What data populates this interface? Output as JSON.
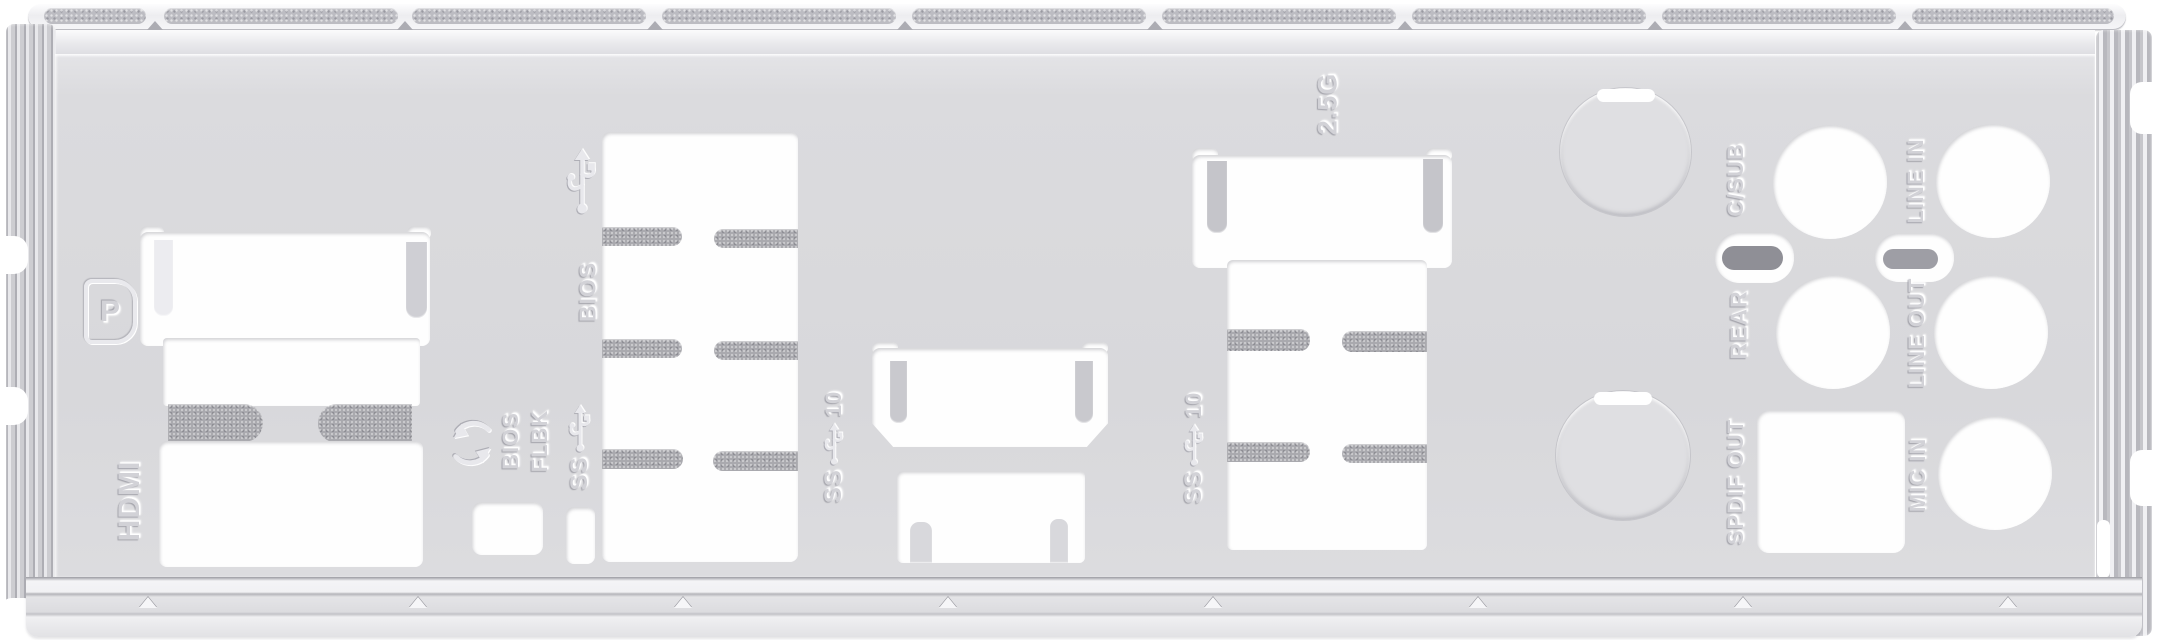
{
  "object": "motherboard-rear-io-shield-photo",
  "description": "Stamped metal I/O shield plate, light gray, with port cutouts, spring fingers, knockout circles and embossed port labels",
  "colors": {
    "plate": "#dbdbde",
    "cutout": "#fefefe",
    "spring_finger": "#a9a9ae",
    "emi_strip": "#bcbcc2",
    "emboss": "#d2d2d7",
    "background": "#ffffff"
  },
  "labels": {
    "display_port_logo": "P",
    "hdmi": "HDMI",
    "usb_bios": "BIOS",
    "bios_flashback_line1": "BIOS",
    "bios_flashback_line2": "FLBK",
    "usb_superspeed": "SS",
    "usb_superspeed10_prefix": "SS",
    "usb_superspeed10_speed": "10",
    "lan_speed": "2.5G",
    "audio_csub": "C/SUB",
    "audio_rear": "REAR",
    "audio_spdif_out": "SPDIF OUT",
    "audio_line_in": "LINE IN",
    "audio_line_out": "LINE OUT",
    "audio_mic_in": "MIC IN"
  },
  "icons": [
    "displayport-logo-icon",
    "usb-trident-icon",
    "usb-ss-trident-icon",
    "usb-ss10-trident-icon",
    "bios-flashback-arrows-icon"
  ],
  "cutouts": [
    "displayport-cutout",
    "hdmi-cutout",
    "usb-stack-4-ports",
    "bios-flashback-button-hole",
    "small-slot-cutout",
    "center-hdmi-cutout",
    "center-port-cutout",
    "lan-2.5g-cutout",
    "usb-stack-2-ports",
    "knockout-circle-top",
    "knockout-circle-bottom",
    "audio-jack-csub",
    "audio-jack-rear",
    "audio-jack-line-in",
    "audio-jack-line-out",
    "audio-jack-mic-in",
    "spdif-optical-square",
    "audio-latch-slot-1",
    "audio-latch-slot-2"
  ]
}
